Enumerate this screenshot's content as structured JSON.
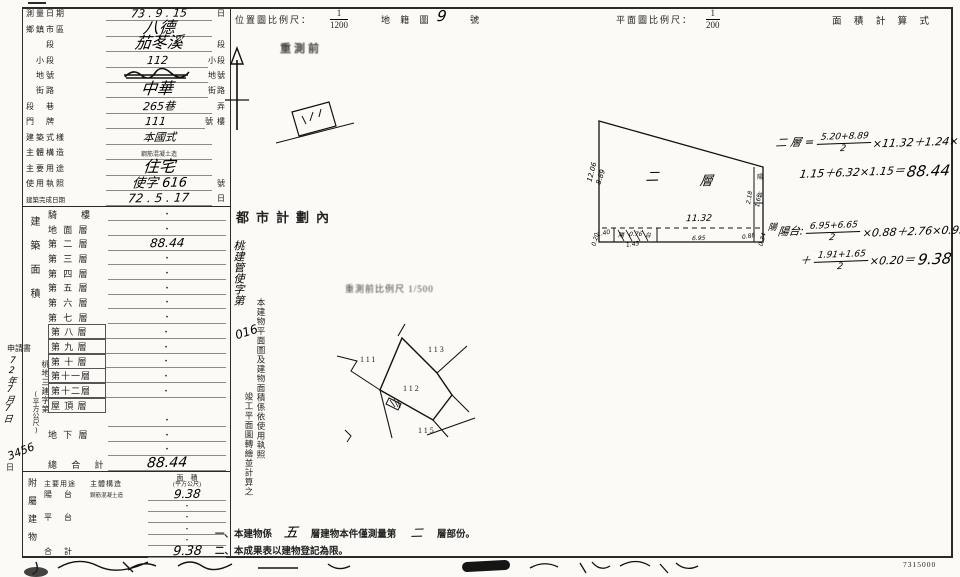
{
  "header": {
    "loc_scale_label": "位置圖比例尺：",
    "loc_scale_num": "1",
    "loc_scale_den": "1200",
    "cadastral_label": "地 籍 圖",
    "cadastral_no": "9",
    "cadastral_unit": "號",
    "plan_scale_label": "平面圖比例尺：",
    "plan_scale_num": "1",
    "plan_scale_den": "200",
    "area_calc_label": "面 積 計 算 式"
  },
  "margin": {
    "applic": "申請書",
    "doc_no": "桃地三建字第",
    "hw_date": "72年7月7日",
    "hw_no": "3456",
    "day": "日"
  },
  "form": {
    "rows": [
      {
        "label": "測量日期",
        "value": "73 . 9 . 15",
        "unit": "日"
      },
      {
        "label": "鄉鎮市區",
        "value": "八德",
        "unit": ""
      },
      {
        "label": "　　段",
        "value": "茄苳溪",
        "unit": "段"
      },
      {
        "label": "　小段",
        "value": "112",
        "unit": "小段"
      },
      {
        "label": "　地號",
        "value": "",
        "unit": "地號"
      },
      {
        "label": "　街路",
        "value": "中華",
        "unit": "街路"
      },
      {
        "label": "段　巷",
        "value": "265巷",
        "unit": "弄"
      },
      {
        "label": "門　牌",
        "value": "111",
        "unit": "號 樓"
      },
      {
        "label": "建築式樣",
        "value": "本國式",
        "unit": ""
      },
      {
        "label": "主體構造",
        "value": "鋼筋混凝土造",
        "unit": ""
      },
      {
        "label": "主要用途",
        "value": "住宅",
        "unit": ""
      },
      {
        "label": "使用執照",
        "value": "使字 616",
        "unit": "號"
      },
      {
        "label": "建築完成日期",
        "value": "72 . 5 . 17",
        "unit": "日"
      }
    ]
  },
  "floors": {
    "section": "建築面積",
    "unit": "(平方公尺)",
    "rows": [
      {
        "label": "騎　　樓",
        "value": "·"
      },
      {
        "label": "地 面 層",
        "value": "·"
      },
      {
        "label": "第 二 層",
        "value": "88.44"
      },
      {
        "label": "第 三 層",
        "value": "·"
      },
      {
        "label": "第 四 層",
        "value": "·"
      },
      {
        "label": "第 五 層",
        "value": "·"
      },
      {
        "label": "第 六 層",
        "value": "·"
      },
      {
        "label": "第 七 層",
        "value": "·"
      },
      {
        "label": "第 八 層",
        "value": "·"
      },
      {
        "label": "第 九 層",
        "value": "·"
      },
      {
        "label": "第 十 層",
        "value": "·"
      },
      {
        "label": "第十一層",
        "value": "·"
      },
      {
        "label": "第十二層",
        "value": "·"
      },
      {
        "label": "屋 頂 層",
        "value": ""
      },
      {
        "label": "",
        "value": "·"
      },
      {
        "label": "地 下 層",
        "value": "·"
      },
      {
        "label": "",
        "value": "·"
      },
      {
        "label": "總 合 計",
        "value": "88.44"
      }
    ]
  },
  "annex": {
    "section": "附屬建物",
    "h_use": "主要用途",
    "h_struct": "主體構造",
    "h_area": "面　積",
    "h_area_unit": "(平方公尺)",
    "rows": [
      {
        "use": "陽　台",
        "struct": "鋼筋混凝土造",
        "area": "9.38"
      },
      {
        "use": "",
        "struct": "",
        "area": "·"
      },
      {
        "use": "平　台",
        "struct": "",
        "area": "·"
      },
      {
        "use": "",
        "struct": "",
        "area": "·"
      },
      {
        "use": "",
        "struct": "",
        "area": "·"
      },
      {
        "use": "合　計",
        "struct": "",
        "area": "9.38"
      }
    ]
  },
  "stamps": {
    "presurvey": "重測前",
    "urban": "都市計劃內",
    "permit": "桃建管使字第",
    "permit_no": "016",
    "note_col1": "本建物平面圖及建物面積係依使用執照",
    "note_col2": "竣工平面圖轉繪並計算之",
    "sketch_scale": "重測前比例尺 1/500"
  },
  "sketch": {
    "p111": "111",
    "p112": "112",
    "p113": "113",
    "p115": "115"
  },
  "plan": {
    "label_a": "二",
    "label_b": "層",
    "width": "11.32",
    "left1": "12.06",
    "left2": "8.89",
    "b1": "1.40",
    "b2": "0.20",
    "b3": "陽",
    "b4": "0.76",
    "b5": "台",
    "b6": "1.43",
    "b7": "6.95",
    "r1": "2.18",
    "r2": "1.65",
    "r3": "0.88",
    "r4": "0.34",
    "r5": "陽",
    "r6": "台",
    "r7": "陽"
  },
  "calc": {
    "t1": "二 層 =",
    "f1n": "5.20+8.89",
    "f1d": "2",
    "t2": "×11.32＋1.24×",
    "t3": "1.15＋6.32×1.15＝",
    "r1": "88.44",
    "t4": "陽台:",
    "f2n": "6.95+6.65",
    "f2d": "2",
    "t5": "×0.88＋2.76×0.95",
    "t6": "＋",
    "f3n": "1.91+1.65",
    "f3d": "2",
    "t7": "×0.20＝",
    "r2": "9.38"
  },
  "notes": {
    "a1": "一、本建物係",
    "hw1": "五",
    "a2": "層建物本件僅測量第",
    "hw2": "二",
    "a3": "層部份。",
    "b": "二、本成果表以建物登記為限。"
  },
  "footer": {
    "code": "7315000"
  }
}
